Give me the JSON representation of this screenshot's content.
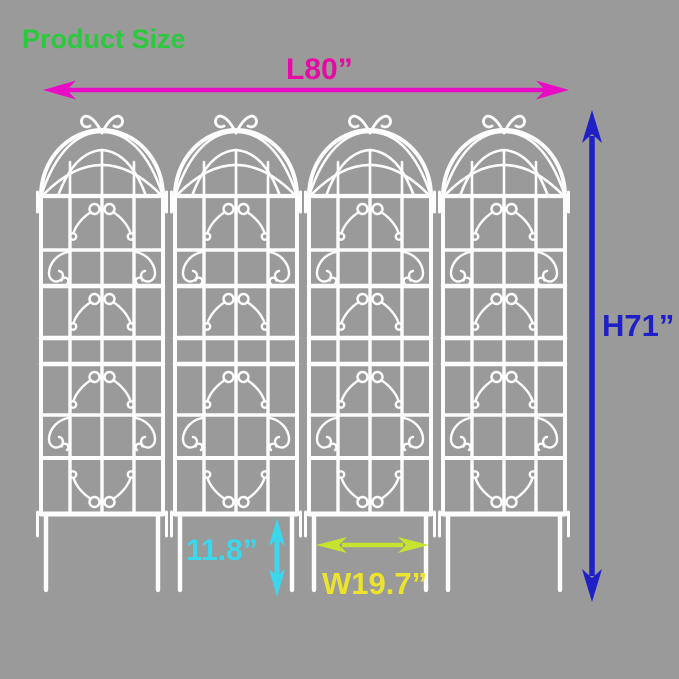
{
  "background_color": "#9a9a9a",
  "title": {
    "text": "Product Size",
    "color": "#2cc83e"
  },
  "product": {
    "name": "metal garden trellis panels",
    "panel_count": 4,
    "color": "#fdfdfd"
  },
  "dimensions": {
    "length": {
      "label": "L80”",
      "text_color": "#e60aa4",
      "arrow_color": "#e80cc4"
    },
    "height": {
      "label": "H71”",
      "text_color": "#1f1fc8",
      "arrow_color": "#1f1fc8"
    },
    "leg_height": {
      "label": "11.8”",
      "text_color": "#3bd7ec",
      "arrow_color": "#3bd7ec"
    },
    "panel_width": {
      "label": "W19.7”",
      "text_color": "#ece42c",
      "arrow_color": "#c8e32f"
    }
  }
}
